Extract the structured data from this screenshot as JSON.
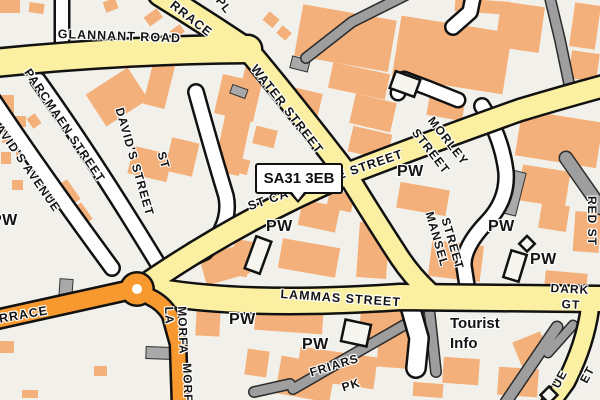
{
  "map": {
    "description": "Street map of Carmarthen town centre area",
    "postcode_marker": {
      "text": "SA31 3EB"
    },
    "colors": {
      "background": "#F2F0EA",
      "building": "#F4B07A",
      "road_yellow": "#FBF0A2",
      "road_orange": "#F8992F",
      "road_white": "#FFFFFF",
      "path_gray": "#9E9E9E",
      "casing": "#111111"
    }
  },
  "map_labels": [
    {
      "name": "label-glannant-road",
      "kind": "street",
      "text": "GLANNANT ROAD",
      "x": 58,
      "y": 27,
      "rot": 2,
      "size": 12.5
    },
    {
      "name": "label-terrace-fragment-top",
      "kind": "street",
      "text": "RRACE",
      "x": 176,
      "y": -2,
      "rot": 38,
      "size": 12.5
    },
    {
      "name": "label-pl-fragment",
      "kind": "street",
      "text": "PL",
      "x": 224,
      "y": -6,
      "rot": 52,
      "size": 12
    },
    {
      "name": "label-water-street",
      "kind": "street",
      "text": "WATER STREET",
      "x": 259,
      "y": 62,
      "rot": 52,
      "size": 12.5
    },
    {
      "name": "label-st-catherine-street",
      "kind": "street",
      "text": "ST CATHERINE STREET",
      "x": 246,
      "y": 200,
      "rot": -19,
      "size": 12.5
    },
    {
      "name": "label-parcmaen-street",
      "kind": "street",
      "text": "PARCMAEN STREET",
      "x": 33,
      "y": 66,
      "rot": 56,
      "size": 12
    },
    {
      "name": "label-st-davids-avenue",
      "kind": "street",
      "text": "ST DAVID'S AVENUE",
      "x": -14,
      "y": 96,
      "rot": 55,
      "size": 12
    },
    {
      "name": "label-st-davids-street-line1",
      "kind": "street",
      "text": "ST",
      "x": 168,
      "y": 150,
      "rot": 74,
      "size": 12
    },
    {
      "name": "label-st-davids-street-line2",
      "kind": "street",
      "text": "DAVID'S STREET",
      "x": 126,
      "y": 106,
      "rot": 74,
      "size": 12
    },
    {
      "name": "label-st-fragment-left",
      "kind": "street",
      "text": "ST",
      "x": -6,
      "y": 158,
      "rot": 74,
      "size": 12
    },
    {
      "name": "label-morley-street-line1",
      "kind": "street",
      "text": "MORLEY",
      "x": 436,
      "y": 114,
      "rot": 52,
      "size": 12
    },
    {
      "name": "label-morley-street-line2",
      "kind": "street",
      "text": "STREET",
      "x": 420,
      "y": 126,
      "rot": 52,
      "size": 12
    },
    {
      "name": "label-mansel-street-line1",
      "kind": "street",
      "text": "MANSEL",
      "x": 436,
      "y": 210,
      "rot": 74,
      "size": 12
    },
    {
      "name": "label-mansel-street-line2",
      "kind": "street",
      "text": "STREET",
      "x": 452,
      "y": 216,
      "rot": 74,
      "size": 12
    },
    {
      "name": "label-red-street",
      "kind": "street",
      "text": "RED ST",
      "x": 599,
      "y": 196,
      "rot": 90,
      "size": 12
    },
    {
      "name": "label-lammas-street",
      "kind": "street",
      "text": "LAMMAS STREET",
      "x": 281,
      "y": 287,
      "rot": 4,
      "size": 12.5
    },
    {
      "name": "label-dark-gt-line1",
      "kind": "street",
      "text": "DARK",
      "x": 551,
      "y": 281,
      "rot": 3,
      "size": 12
    },
    {
      "name": "label-dark-gt-line2",
      "kind": "street",
      "text": "GT",
      "x": 562,
      "y": 297,
      "rot": 3,
      "size": 12
    },
    {
      "name": "label-blue-street-frag1",
      "kind": "street",
      "text": "UE",
      "x": 549,
      "y": 384,
      "rot": -62,
      "size": 12
    },
    {
      "name": "label-blue-street-frag2",
      "kind": "street",
      "text": "ET",
      "x": 577,
      "y": 379,
      "rot": -62,
      "size": 12
    },
    {
      "name": "label-friars-pk-line1",
      "kind": "street",
      "text": "FRIARS",
      "x": 308,
      "y": 366,
      "rot": -17,
      "size": 12
    },
    {
      "name": "label-friars-pk-line2",
      "kind": "street",
      "text": "PK",
      "x": 340,
      "y": 381,
      "rot": -17,
      "size": 12
    },
    {
      "name": "label-morfa-la",
      "kind": "street wrapped",
      "text": "MORFA LA",
      "x": 188,
      "y": 306,
      "rot": 88,
      "size": 12,
      "w": 52
    },
    {
      "name": "label-morfa-fragment",
      "kind": "street",
      "text": "MORFA",
      "x": 194,
      "y": 363,
      "rot": 88,
      "size": 12
    },
    {
      "name": "label-terrace-fragment-west",
      "kind": "street",
      "text": "RRACE",
      "x": -2,
      "y": 312,
      "rot": -10,
      "size": 12.5
    },
    {
      "name": "label-pw-1",
      "kind": "poi",
      "text": "PW",
      "x": -9,
      "y": 212
    },
    {
      "name": "label-pw-2",
      "kind": "poi",
      "text": "PW",
      "x": 266,
      "y": 218
    },
    {
      "name": "label-pw-3",
      "kind": "poi",
      "text": "PW",
      "x": 397,
      "y": 163
    },
    {
      "name": "label-pw-4",
      "kind": "poi",
      "text": "PW",
      "x": 488,
      "y": 218
    },
    {
      "name": "label-pw-5",
      "kind": "poi",
      "text": "PW",
      "x": 530,
      "y": 251
    },
    {
      "name": "label-pw-6",
      "kind": "poi",
      "text": "PW",
      "x": 229,
      "y": 311
    },
    {
      "name": "label-pw-7",
      "kind": "poi",
      "text": "PW",
      "x": 302,
      "y": 336
    },
    {
      "name": "label-tourist-info-line1",
      "kind": "place",
      "text": "Tourist",
      "x": 450,
      "y": 315
    },
    {
      "name": "label-tourist-info-line2",
      "kind": "place",
      "text": "Info",
      "x": 450,
      "y": 335
    }
  ]
}
